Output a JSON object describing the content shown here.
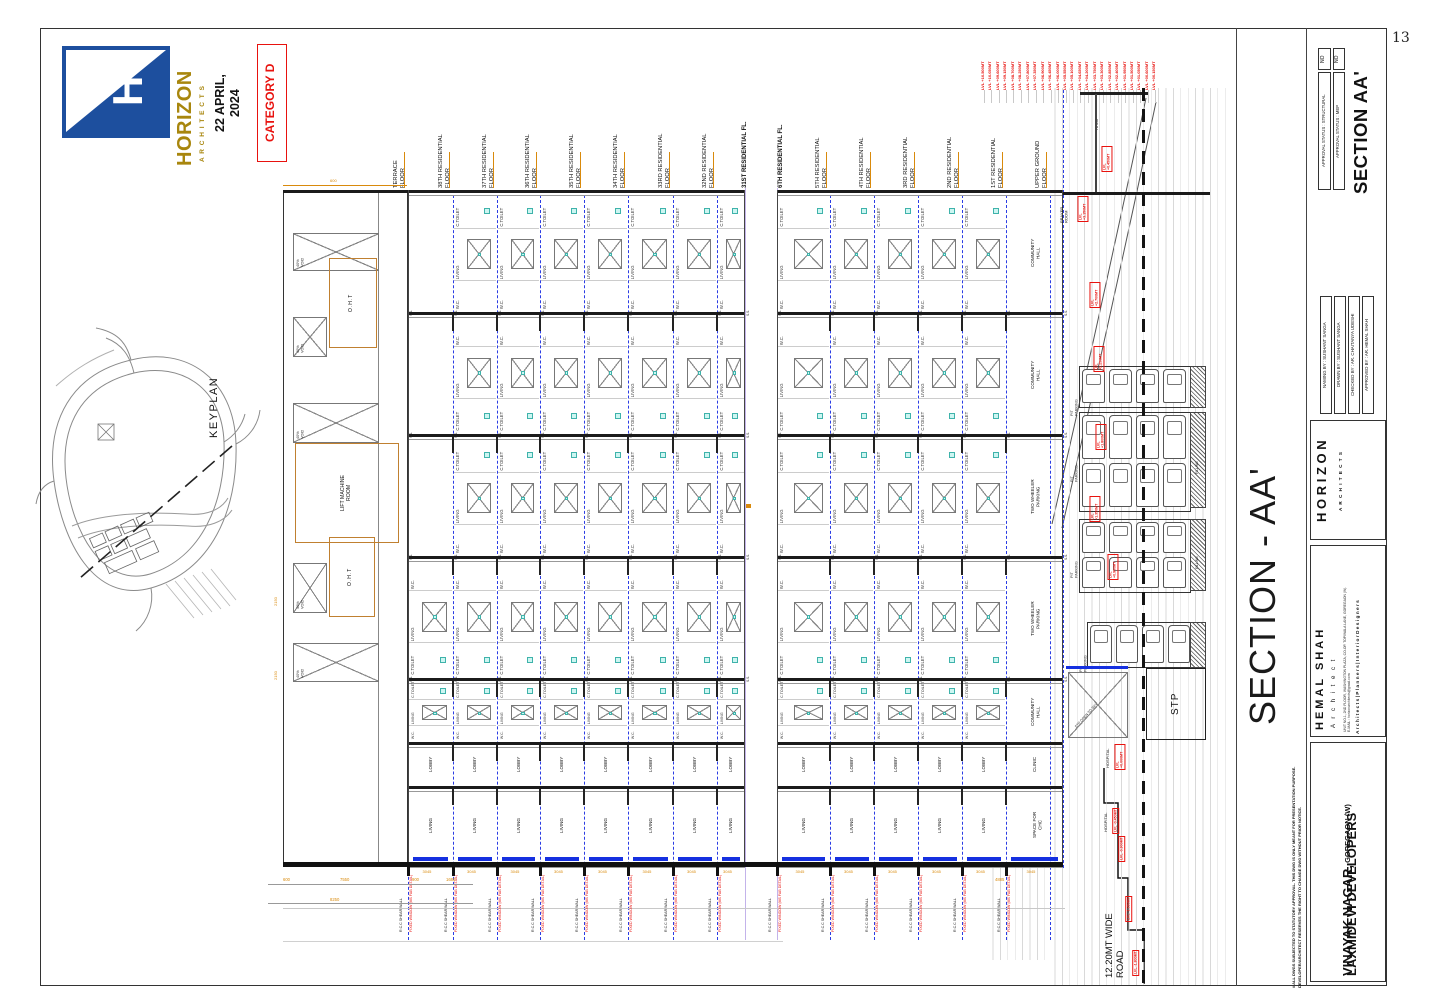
{
  "page": {
    "number": "13"
  },
  "header": {
    "brand": "HORIZON",
    "brand_sub": "A R C H I T E C T S",
    "logo_h": "H",
    "date": "22 APRIL,\n2024",
    "category": "CATEGORY D",
    "colors": {
      "logo_blue": "#1d4f9e",
      "gold": "#a8860d",
      "red": "#e8120e"
    }
  },
  "keyplan": {
    "label": "KEYPLAN"
  },
  "drawing": {
    "left_floors": [
      "TERRACE\nFLOOR",
      "38TH RESIDENTIAL\nFLOOR",
      "37TH RESIDENTIAL\nFLOOR",
      "36TH RESIDENTIAL\nFLOOR",
      "35TH RESIDENTIAL\nFLOOR",
      "34TH RESIDENTIAL\nFLOOR",
      "33RD RESIDENTIAL\nFLOOR",
      "32ND RESIDENTIAL\nFLOOR",
      "31ST RESIDENTIAL FL."
    ],
    "right_floors": [
      "6TH RESIDENTIAL FL.",
      "5TH RESIDENTIAL\nFLOOR",
      "4TH RESIDENTIAL\nFLOOR",
      "3RD RESIDENTIAL\nFLOOR",
      "2ND RESIDENTIAL\nFLOOR",
      "1ST RESIDENTIAL\nFLOOR",
      "UPPER GROUND\nFLOOR"
    ],
    "rooms": {
      "toilet": "C.TOILET",
      "living": "LIVING",
      "wc": "W.C.",
      "ss": "S.S.",
      "lobby": "LOBBY"
    },
    "community_bands": [
      "COMMUNITY\nHALL",
      "COMMUNITY\nHALL",
      "TWO WHEELER\nPARKING",
      "TWO WHEELER\nPARKING",
      "COMMUNITY\nHALL"
    ],
    "community_lobby": "CLINIC",
    "community_living": "SPACE FOR\nCHC",
    "annotations": {
      "void": "40%\nVOID",
      "oht": "O.H.T",
      "lift": "LIFT MACHINE\nROOM",
      "prayer": "PRAYER\nROOM",
      "ramp": "RAMP",
      "pit": "PIT\nPARKING",
      "filling": "FILLING",
      "stp": "STP",
      "stp_open": "STP OPEN TO SKY",
      "hospital": "HOSPITAL",
      "road": "12.20MT WIDE\nROAD",
      "rcc": "R.C.C SHEAR WALL",
      "fixed_window": "FIXED WINDOW (MS FAB DETAIL)"
    },
    "levels": [
      "LVL +10.500MT",
      "LVL +10.050MT",
      "LVL +09.600MT",
      "LVL +09.150MT",
      "LVL +08.700MT",
      "LVL +08.250MT",
      "LVL +07.800MT",
      "LVL +07.350MT",
      "LVL +06.900MT",
      "LVL +06.450MT",
      "LVL +06.000MT",
      "LVL +05.550MT",
      "LVL +05.100MT",
      "LVL +04.650MT",
      "LVL +04.200MT",
      "LVL +03.750MT",
      "LVL +03.300MT",
      "LVL +02.850MT",
      "LVL +02.400MT",
      "LVL +01.950MT",
      "LVL +01.500MT",
      "LVL +01.050MT",
      "LVL +00.600MT",
      "LVL +00.150MT"
    ],
    "levels_small": [
      "LVL +3.150MT",
      "LVL +2.700MT",
      "LVL +2.250MT",
      "LVL +1.800MT",
      "LVL +1.350MT",
      "LVL +0.900MT",
      "LVL +0.450MT",
      "LVL +0.000MT",
      "LVL -0.450MT",
      "LVL -0.900MT",
      "LVL -1.350MT",
      "LVL -1.800MT"
    ],
    "dims": {
      "d600": "600",
      "d3045": "3045",
      "d7550": "7550",
      "d900": "900",
      "d1685": "1685",
      "d8250": "8250",
      "d2150": "2150",
      "d4885": "4885"
    }
  },
  "titleblock": {
    "sheet_title": "SECTION AA'",
    "big_title": "SECTION - AA'",
    "approval": [
      {
        "label": "APPROVAL STATUS : STRUCTURAL",
        "value": "NO"
      },
      {
        "label": "APPROVAL STATUS : MEP",
        "value": "NO"
      }
    ],
    "credits": [
      "NAMING BY : SUSHANT SANGA",
      "DRAWN BY : SUSHANT SANGA",
      "CHECKED BY : AR. CHAITANYA UDESHI",
      "APPROVED BY : AR. HEMAL SHAH"
    ],
    "firm": {
      "name": "H O R I Z O N",
      "sub": "A R C H I T E C T S"
    },
    "architect": {
      "name": "HEMAL SHAH",
      "role": "A r c h i t e c t",
      "address": "UNIT NO.1, 2ND FLOOR, WASHINGTON PLAZA, CO-OP. TOPIWALA LANE, GOREGAON (W).\nE-MAIL : horizonarchitects@gmail.com",
      "tagline": "A r c h i t e c t s  |  P l a n n e r s  |  I n t e r i o r   D e s i g n e r s"
    },
    "disclaimer": "# ALL DWGS SUBJECTED TO STATUTORY APPROVAL. THIS DWG IS ONLY MEANT FOR PRESENTATION PURPOSE.\nDEVELOPER/ARCHITECT RESERVES THE RIGHT TO CHANGE DWG WITHOUT PRIOR NOTICE.",
    "project": "VINAYAK NAGAR,",
    "project_sub": " GOREGAON (W)",
    "client": "LAXMIDEVI DEVELOPERS"
  }
}
